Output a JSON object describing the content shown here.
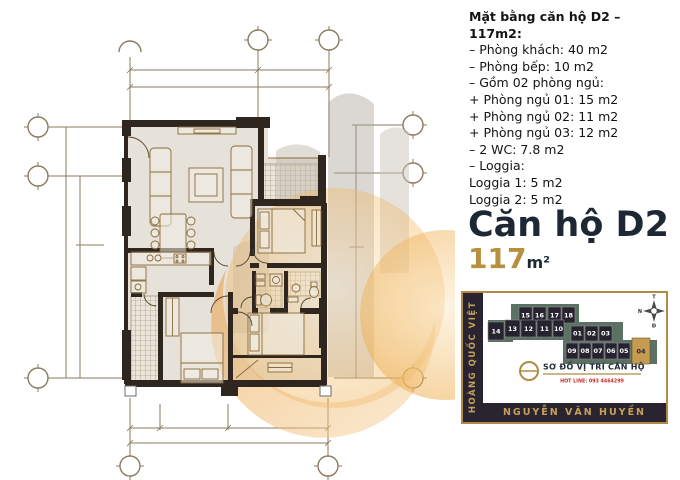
{
  "info": {
    "heading": "Mặt bằng căn hộ D2 – 117m2:",
    "lines": [
      "– Phòng khách: 40 m2",
      "– Phòng bếp: 10 m2",
      "– Gồm 02 phòng ngủ:",
      "+ Phòng ngủ 01: 15 m2",
      "+ Phòng ngủ 02: 11 m2",
      "+ Phòng ngủ 03: 12 m2",
      "– 2 WC: 7.8 m2",
      "– Loggia:",
      "Loggia 1: 5 m2",
      "Loggia 2: 5 m2"
    ]
  },
  "title": {
    "name": "Căn hộ D2",
    "area_value": "117",
    "area_unit": "m²"
  },
  "location": {
    "street_left": "HOÀNG QUỐC VIỆT",
    "street_bottom": "NGUYỄN VĂN HUYỀN",
    "caption": "SƠ ĐỒ VỊ TRÍ CĂN HỘ",
    "hotline": "HOT LINE: 093 4464299",
    "highlighted_unit": "04",
    "compass": {
      "top": "T",
      "right": "B",
      "left": "N",
      "bottom": "Đ"
    },
    "units": [
      {
        "label": "15"
      },
      {
        "label": "16"
      },
      {
        "label": "17"
      },
      {
        "label": "18"
      },
      {
        "label": "14"
      },
      {
        "label": "13"
      },
      {
        "label": "12"
      },
      {
        "label": "11"
      },
      {
        "label": "10"
      },
      {
        "label": "01"
      },
      {
        "label": "02"
      },
      {
        "label": "03"
      },
      {
        "label": "09"
      },
      {
        "label": "08"
      },
      {
        "label": "07"
      },
      {
        "label": "06"
      },
      {
        "label": "05"
      },
      {
        "label": "04"
      }
    ]
  },
  "colors": {
    "title_navy": "#1e2734",
    "accent_gold": "#b6903f",
    "strip_dark": "#2a2430",
    "strip_text_gold": "#c3a05a",
    "map_teal": "#5b7163",
    "unit_dark": "#262230",
    "unit_highlight": "#c49b50",
    "hotline_red": "#cc2a2a",
    "wall_dark": "#2f2620",
    "watermark_orange": "#e8952f"
  }
}
